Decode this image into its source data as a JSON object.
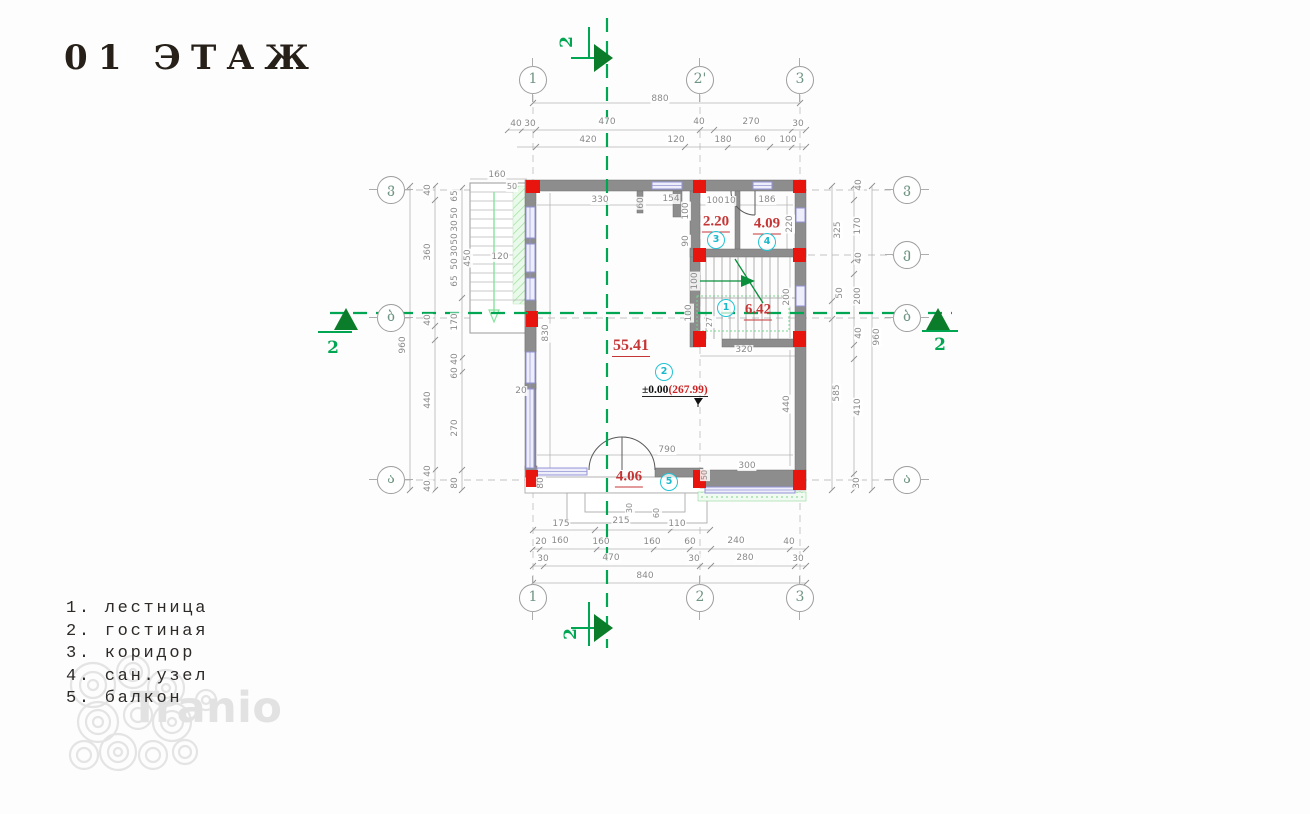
{
  "title": "01 ЭТАЖ",
  "legend": {
    "items": [
      "1. лестница",
      "2. гостиная",
      "3. коридор",
      "4. сан.узел",
      "5. балкон"
    ]
  },
  "watermark": "Tranio",
  "colors": {
    "wall_gray": "#8d8d8d",
    "column_red": "#e8150f",
    "area_red": "#c63535",
    "room_cyan": "#23c4d4",
    "section_green": "#00a651",
    "arrow_dark_green": "#0b7d2a",
    "stair_hatch_green": "#9fdf9f",
    "window_blue": "#9393d6",
    "dim_gray": "#8a8a8a"
  },
  "level_mark": {
    "prefix": "±0.00",
    "elevation": "(267.99)"
  },
  "grid_bubbles": [
    {
      "label": "1",
      "x": 533,
      "y": 80,
      "o": "v"
    },
    {
      "label": "2'",
      "x": 700,
      "y": 80,
      "o": "v"
    },
    {
      "label": "3",
      "x": 800,
      "y": 80,
      "o": "v"
    },
    {
      "label": "1",
      "x": 533,
      "y": 598,
      "o": "v"
    },
    {
      "label": "2",
      "x": 700,
      "y": 598,
      "o": "v"
    },
    {
      "label": "3",
      "x": 800,
      "y": 598,
      "o": "v"
    },
    {
      "label": "ვ",
      "x": 391,
      "y": 190,
      "o": "h"
    },
    {
      "label": "ბ",
      "x": 391,
      "y": 318,
      "o": "h"
    },
    {
      "label": "ა",
      "x": 391,
      "y": 480,
      "o": "h"
    },
    {
      "label": "ვ",
      "x": 907,
      "y": 190,
      "o": "h"
    },
    {
      "label": "ე",
      "x": 907,
      "y": 255,
      "o": "h"
    },
    {
      "label": "ბ",
      "x": 907,
      "y": 318,
      "o": "h"
    },
    {
      "label": "ა",
      "x": 907,
      "y": 480,
      "o": "h"
    }
  ],
  "section_labels": [
    {
      "text": "2",
      "x": 567,
      "y": 42,
      "rot": true
    },
    {
      "text": "2",
      "x": 571,
      "y": 634,
      "rot": true
    },
    {
      "text": "2",
      "x": 333,
      "y": 348,
      "rot": false
    },
    {
      "text": "2",
      "x": 940,
      "y": 345,
      "rot": false
    }
  ],
  "room_areas": [
    {
      "value": "2.20",
      "x": 716,
      "y": 223,
      "big": false
    },
    {
      "value": "4.09",
      "x": 767,
      "y": 225,
      "big": false
    },
    {
      "value": "6.42",
      "x": 758,
      "y": 311,
      "big": false
    },
    {
      "value": "55.41",
      "x": 631,
      "y": 347,
      "big": true
    },
    {
      "value": "4.06",
      "x": 629,
      "y": 478,
      "big": false
    }
  ],
  "room_numbers": [
    {
      "value": "3",
      "x": 716,
      "y": 240
    },
    {
      "value": "4",
      "x": 767,
      "y": 242
    },
    {
      "value": "1",
      "x": 726,
      "y": 308
    },
    {
      "value": "2",
      "x": 664,
      "y": 372
    },
    {
      "value": "5",
      "x": 669,
      "y": 482
    }
  ],
  "dimensions": [
    {
      "t": "880",
      "x": 660,
      "y": 99
    },
    {
      "t": "40",
      "x": 516,
      "y": 124
    },
    {
      "t": "30",
      "x": 530,
      "y": 124
    },
    {
      "t": "470",
      "x": 607,
      "y": 122
    },
    {
      "t": "40",
      "x": 699,
      "y": 122
    },
    {
      "t": "270",
      "x": 751,
      "y": 122
    },
    {
      "t": "30",
      "x": 798,
      "y": 124
    },
    {
      "t": "420",
      "x": 588,
      "y": 140
    },
    {
      "t": "120",
      "x": 676,
      "y": 140
    },
    {
      "t": "180",
      "x": 723,
      "y": 140
    },
    {
      "t": "60",
      "x": 760,
      "y": 140
    },
    {
      "t": "100",
      "x": 788,
      "y": 140
    },
    {
      "t": "160",
      "x": 497,
      "y": 175
    },
    {
      "t": "50",
      "x": 512,
      "y": 187,
      "s": true
    },
    {
      "t": "330",
      "x": 600,
      "y": 200
    },
    {
      "t": "60",
      "x": 641,
      "y": 203,
      "v": true
    },
    {
      "t": "154",
      "x": 671,
      "y": 199
    },
    {
      "t": "100",
      "x": 715,
      "y": 201
    },
    {
      "t": "10",
      "x": 730,
      "y": 201
    },
    {
      "t": "186",
      "x": 767,
      "y": 200
    },
    {
      "t": "100",
      "x": 686,
      "y": 211,
      "v": true
    },
    {
      "t": "220",
      "x": 790,
      "y": 224,
      "v": true
    },
    {
      "t": "90",
      "x": 686,
      "y": 241,
      "v": true
    },
    {
      "t": "450",
      "x": 468,
      "y": 258,
      "v": true
    },
    {
      "t": "120",
      "x": 500,
      "y": 257
    },
    {
      "t": "100",
      "x": 695,
      "y": 281,
      "v": true
    },
    {
      "t": "200",
      "x": 787,
      "y": 297,
      "v": true
    },
    {
      "t": "100",
      "x": 689,
      "y": 313,
      "v": true
    },
    {
      "t": "27",
      "x": 710,
      "y": 322,
      "v": true,
      "s": true
    },
    {
      "t": "320",
      "x": 744,
      "y": 350
    },
    {
      "t": "830",
      "x": 546,
      "y": 333,
      "v": true
    },
    {
      "t": "20",
      "x": 521,
      "y": 391
    },
    {
      "t": "790",
      "x": 667,
      "y": 450
    },
    {
      "t": "440",
      "x": 787,
      "y": 404,
      "v": true
    },
    {
      "t": "300",
      "x": 747,
      "y": 466
    },
    {
      "t": "50",
      "x": 705,
      "y": 475,
      "v": true,
      "s": true
    },
    {
      "t": "80",
      "x": 541,
      "y": 483,
      "v": true
    },
    {
      "t": "30",
      "x": 630,
      "y": 508,
      "v": true,
      "s": true
    },
    {
      "t": "60",
      "x": 657,
      "y": 513,
      "v": true,
      "s": true
    },
    {
      "t": "40",
      "x": 428,
      "y": 190,
      "v": true
    },
    {
      "t": "360",
      "x": 428,
      "y": 252,
      "v": true
    },
    {
      "t": "40",
      "x": 428,
      "y": 320,
      "v": true
    },
    {
      "t": "440",
      "x": 428,
      "y": 400,
      "v": true
    },
    {
      "t": "40",
      "x": 428,
      "y": 471,
      "v": true
    },
    {
      "t": "40",
      "x": 428,
      "y": 486,
      "v": true
    },
    {
      "t": "960",
      "x": 403,
      "y": 345,
      "v": true
    },
    {
      "t": "65",
      "x": 455,
      "y": 196,
      "v": true
    },
    {
      "t": "50",
      "x": 455,
      "y": 213,
      "v": true
    },
    {
      "t": "30",
      "x": 455,
      "y": 226,
      "v": true
    },
    {
      "t": "50",
      "x": 455,
      "y": 239,
      "v": true
    },
    {
      "t": "30",
      "x": 455,
      "y": 251,
      "v": true
    },
    {
      "t": "50",
      "x": 455,
      "y": 264,
      "v": true
    },
    {
      "t": "65",
      "x": 455,
      "y": 281,
      "v": true
    },
    {
      "t": "170",
      "x": 455,
      "y": 322,
      "v": true
    },
    {
      "t": "40",
      "x": 455,
      "y": 359,
      "v": true
    },
    {
      "t": "60",
      "x": 455,
      "y": 373,
      "v": true
    },
    {
      "t": "270",
      "x": 455,
      "y": 428,
      "v": true
    },
    {
      "t": "80",
      "x": 455,
      "y": 483,
      "v": true
    },
    {
      "t": "325",
      "x": 838,
      "y": 230,
      "v": true
    },
    {
      "t": "50",
      "x": 840,
      "y": 293,
      "v": true
    },
    {
      "t": "585",
      "x": 837,
      "y": 393,
      "v": true
    },
    {
      "t": "40",
      "x": 859,
      "y": 185,
      "v": true
    },
    {
      "t": "170",
      "x": 858,
      "y": 226,
      "v": true
    },
    {
      "t": "40",
      "x": 859,
      "y": 258,
      "v": true
    },
    {
      "t": "200",
      "x": 858,
      "y": 296,
      "v": true
    },
    {
      "t": "40",
      "x": 859,
      "y": 333,
      "v": true
    },
    {
      "t": "410",
      "x": 858,
      "y": 407,
      "v": true
    },
    {
      "t": "30",
      "x": 857,
      "y": 483,
      "v": true
    },
    {
      "t": "960",
      "x": 877,
      "y": 337,
      "v": true
    },
    {
      "t": "175",
      "x": 561,
      "y": 524
    },
    {
      "t": "215",
      "x": 621,
      "y": 521
    },
    {
      "t": "110",
      "x": 677,
      "y": 524
    },
    {
      "t": "20",
      "x": 541,
      "y": 542
    },
    {
      "t": "160",
      "x": 560,
      "y": 541
    },
    {
      "t": "160",
      "x": 601,
      "y": 542
    },
    {
      "t": "160",
      "x": 652,
      "y": 542
    },
    {
      "t": "60",
      "x": 690,
      "y": 542
    },
    {
      "t": "240",
      "x": 736,
      "y": 541
    },
    {
      "t": "40",
      "x": 789,
      "y": 542
    },
    {
      "t": "30",
      "x": 543,
      "y": 559
    },
    {
      "t": "470",
      "x": 611,
      "y": 558
    },
    {
      "t": "30",
      "x": 694,
      "y": 559
    },
    {
      "t": "280",
      "x": 745,
      "y": 558
    },
    {
      "t": "30",
      "x": 798,
      "y": 559
    },
    {
      "t": "840",
      "x": 645,
      "y": 576
    }
  ]
}
